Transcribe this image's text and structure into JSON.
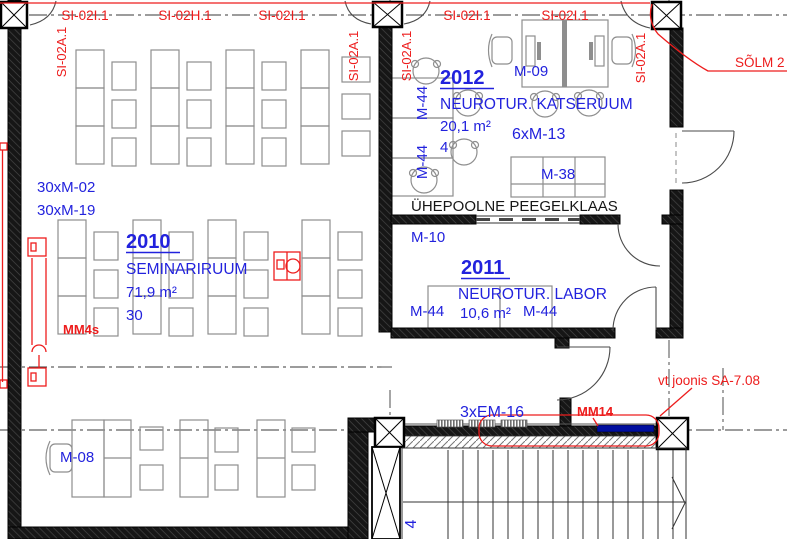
{
  "colors": {
    "annotation_red": "#ed1c1c",
    "label_blue": "#2222dd",
    "wall_black": "#141414",
    "furniture_gray": "#8e8e8e",
    "mm14_bar_blue": "#000e9e"
  },
  "markers": {
    "top_sections": [
      "SI-02I.1",
      "SI-02H.1",
      "SI-02I.1",
      "SI-02I.1",
      "SI-02I.1"
    ],
    "column_tag": "SI-02A.1",
    "node_callout": "SÕLM 2",
    "detail_reference": "vt joonis SA-7.08",
    "duct_label": "MM4s",
    "sill_label": "MM14"
  },
  "rooms": {
    "r2010": {
      "number": "2010",
      "name": "SEMINARIRUUM",
      "area": "71,9 m²",
      "capacity": "30"
    },
    "r2011": {
      "number": "2011",
      "name": "NEUROTUR. LABOR",
      "area": "10,6 m²"
    },
    "r2012": {
      "number": "2012",
      "name": "NEUROTUR. KATSERUUM",
      "area": "20,1 m²",
      "capacity": "4"
    }
  },
  "furniture": {
    "m02": "30xM-02",
    "m19": "30xM-19",
    "m08": "M-08",
    "m09": "M-09",
    "m13": "6xM-13",
    "m38": "M-38",
    "m10": "M-10",
    "m44": "M-44",
    "em16": "3xEM-16",
    "stair": "4"
  },
  "notes": {
    "mirror_glass": "ÜHEPOOLNE PEEGELKLAAS"
  }
}
